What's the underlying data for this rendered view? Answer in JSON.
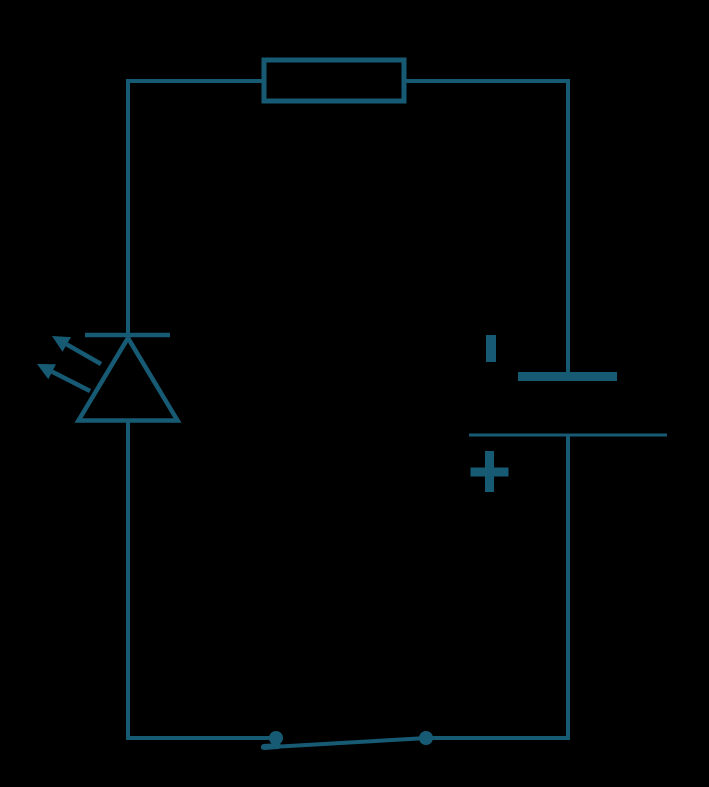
{
  "canvas": {
    "width": 709,
    "height": 787,
    "background": "#000000",
    "stroke_color": "#175a73"
  },
  "diagram": {
    "kind": "circuit-schematic",
    "components": {
      "resistor": {
        "icon": "resistor-rectangle-symbol"
      },
      "led": {
        "icon": "led-diode-symbol",
        "emission_arrows": 2
      },
      "battery": {
        "icon": "battery-cell-symbol",
        "negative_label": "-",
        "positive_label": "+"
      },
      "switch": {
        "icon": "spst-switch-symbol",
        "state": "closed",
        "terminals": 2
      }
    }
  }
}
